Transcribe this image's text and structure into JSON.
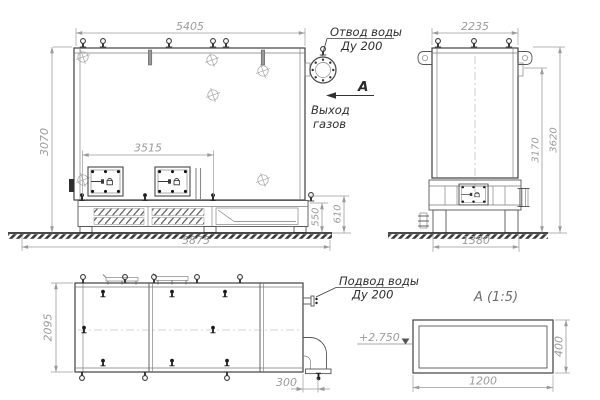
{
  "front_view": {
    "dim_width_top": "5405",
    "dim_height": "3070",
    "dim_doors_span": "3515",
    "dim_width_overall": "5875",
    "dim_base_height_inner": "550",
    "dim_base_height_outer": "610",
    "label_water_outlet_line1": "Отвод воды",
    "label_water_outlet_line2": "Ду 200",
    "label_gas_outlet_line1": "Выход",
    "label_gas_outlet_line2": "газов",
    "section_arrow_letter": "А"
  },
  "side_view": {
    "dim_width_top": "2235",
    "dim_height_inner": "3170",
    "dim_height_overall": "3620",
    "dim_legs_span": "1380"
  },
  "plan_view": {
    "dim_depth": "2095",
    "dim_outlet_offset": "300",
    "label_water_inlet_line1": "Подвод воды",
    "label_water_inlet_line2": "Ду 200"
  },
  "detail_view": {
    "title": "А  (1:5)",
    "dim_width": "1200",
    "dim_height": "400",
    "elevation_mark": "+2.750"
  },
  "colors": {
    "line_main": "#474747",
    "line_dim": "#9a9a9a",
    "text_label": "#2e2e2e"
  }
}
